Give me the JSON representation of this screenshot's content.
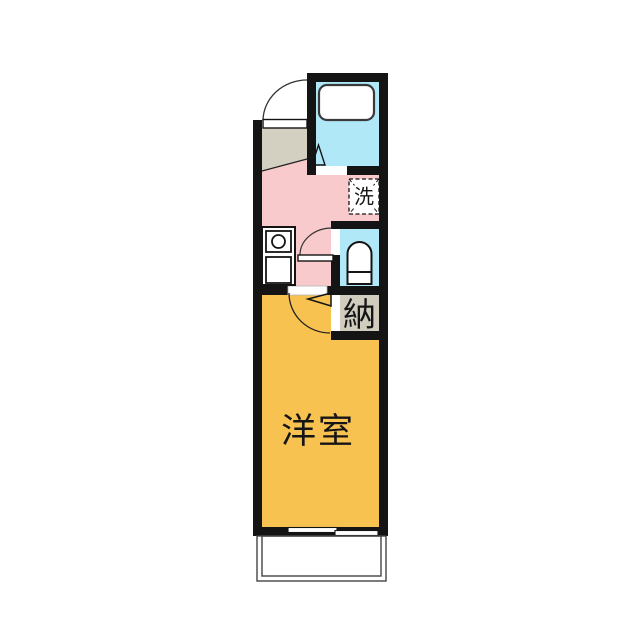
{
  "floor_plan": {
    "labels": {
      "washing_machine": "洗",
      "storage": "納",
      "western_room": "洋室"
    },
    "colors": {
      "background": "#ffffff",
      "wall": "#141414",
      "hallway_kitchen_floor": "#f8cacb",
      "western_room_floor": "#f8c251",
      "bathroom_floor": "#b0e8f8",
      "toilet_floor": "#b0e8f8",
      "entry_floor": "#d3d0c2",
      "storage_floor": "#d0cdbf",
      "fixture_outline": "#3a3a3a",
      "label_text": "#151515"
    },
    "fixtures": [
      "entry-door-swing",
      "entry-step",
      "bathtub",
      "bathroom-folding-door",
      "washing-machine-space",
      "kitchen-burner",
      "kitchen-sink",
      "toilet-bowl",
      "toilet-door-swing",
      "room-door-swing",
      "storage-closet",
      "sliding-window",
      "balcony-railing"
    ]
  }
}
